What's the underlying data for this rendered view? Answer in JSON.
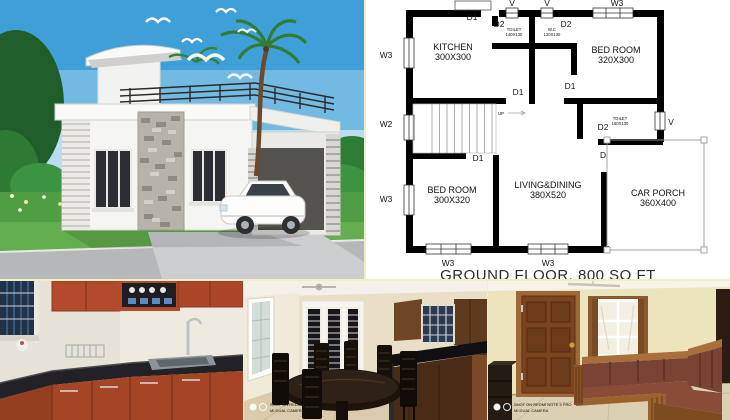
{
  "floor_plan": {
    "caption": "GROUND FLOOR, 800 SQ FT",
    "rooms": [
      {
        "name": "KITCHEN",
        "dims": "300X300",
        "x": 87,
        "y": 50
      },
      {
        "name": "BED ROOM",
        "dims": "320X300",
        "x": 250,
        "y": 53
      },
      {
        "name": "BED ROOM",
        "dims": "300X320",
        "x": 86,
        "y": 193
      },
      {
        "name": "LIVING&DINING",
        "dims": "380X520",
        "x": 182,
        "y": 188
      },
      {
        "name": "CAR PORCH",
        "dims": "360X400",
        "x": 292,
        "y": 196
      }
    ],
    "small_rooms": [
      {
        "name": "TOILET",
        "dims": "140X130",
        "x": 148,
        "y": 31
      },
      {
        "name": "W.C",
        "dims": "120X130",
        "x": 186,
        "y": 31
      },
      {
        "name": "TOILET",
        "dims": "160X130",
        "x": 254,
        "y": 120
      }
    ],
    "markers": [
      {
        "text": "D1",
        "x": 106,
        "y": 20
      },
      {
        "text": "V",
        "x": 146,
        "y": 6
      },
      {
        "text": "V",
        "x": 181,
        "y": 6
      },
      {
        "text": "W3",
        "x": 251,
        "y": 6
      },
      {
        "text": "D2",
        "x": 133,
        "y": 27
      },
      {
        "text": "D2",
        "x": 200,
        "y": 27
      },
      {
        "text": "W3",
        "x": 20,
        "y": 58
      },
      {
        "text": "D1",
        "x": 204,
        "y": 89
      },
      {
        "text": "D1",
        "x": 152,
        "y": 95
      },
      {
        "text": "W2",
        "x": 20,
        "y": 127
      },
      {
        "text": "D2",
        "x": 237,
        "y": 130
      },
      {
        "text": "V",
        "x": 305,
        "y": 125
      },
      {
        "text": "D1",
        "x": 112,
        "y": 161
      },
      {
        "text": "D",
        "x": 237,
        "y": 158
      },
      {
        "text": "W3",
        "x": 20,
        "y": 202
      },
      {
        "text": "W3",
        "x": 82,
        "y": 266
      },
      {
        "text": "W3",
        "x": 182,
        "y": 266
      },
      {
        "text": "UP",
        "x": 135,
        "y": 115,
        "s": 4.5
      }
    ]
  },
  "photos": {
    "watermark": {
      "line1": "SHOT ON REDMI NOTE 5 PRO",
      "line2": "MI DUAL CAMERA"
    }
  },
  "palette": {
    "plan_wall": "#000000",
    "seam_border": "#f1edc6",
    "sky_blue": "#3f9fd8",
    "grass_green": "#4f9e44",
    "cabinet_orange": "#b24a2b",
    "counter_black": "#222226",
    "wood_dark": "#2e2115",
    "wall_cream": "#ece4bd",
    "sofa_wood": "#9a6230",
    "door_brown": "#7c441d"
  }
}
